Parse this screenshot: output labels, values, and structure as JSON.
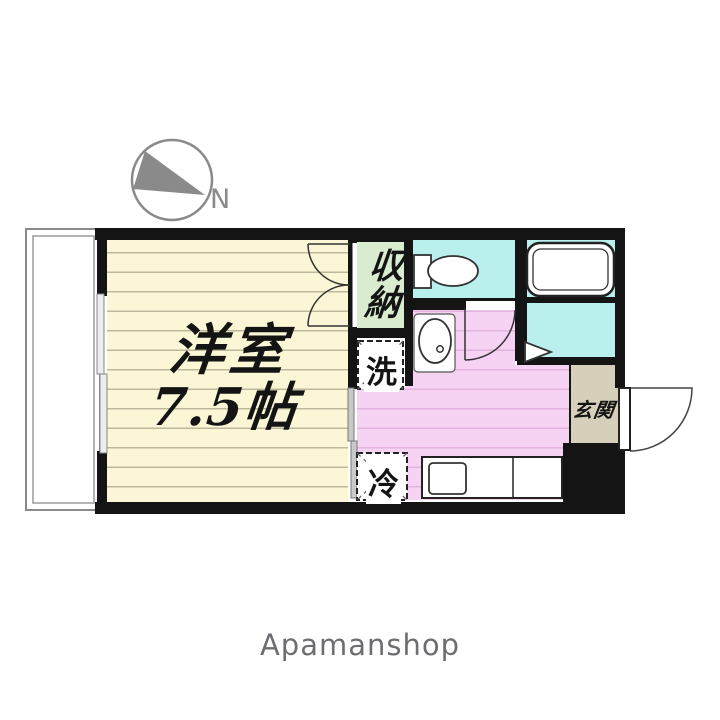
{
  "compass": {
    "label": "N"
  },
  "floor_plan": {
    "main_room": {
      "name": "洋室",
      "size": "7.5帖"
    },
    "closet_label": "収納",
    "washing_machine_label": "洗",
    "refrigerator_label": "冷",
    "entrance_label": "玄関"
  },
  "branding": {
    "name": "Apamanshop"
  },
  "colors": {
    "wall": "#141414",
    "main_room_floor": "#fbf7d6",
    "floor_line": "#bdb89c",
    "kitchen_floor": "#f6d2f3",
    "kitchen_floor_line": "#e2b4df",
    "water_area_cyan": "#b9efec",
    "closet_green": "#d9eccf",
    "entrance_beige": "#d6d0ba",
    "compass_gray": "#8a8a8a",
    "brand_gray": "#6e6e72"
  }
}
